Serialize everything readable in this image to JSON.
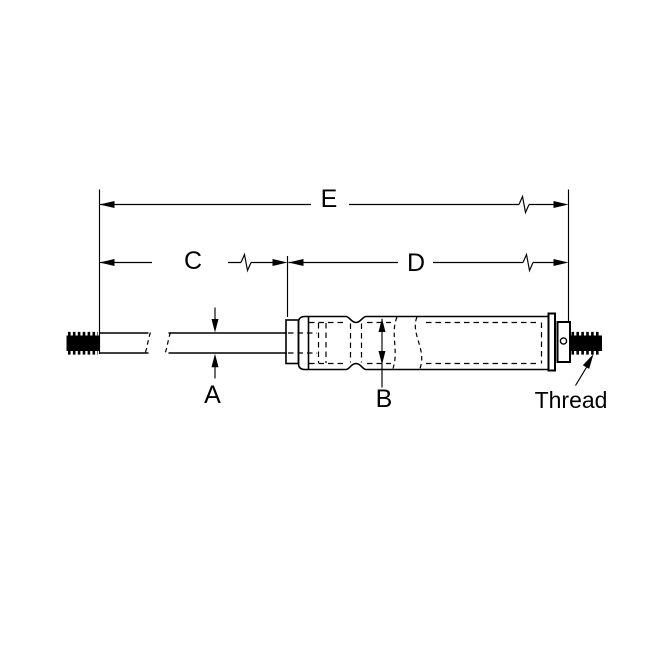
{
  "figure": {
    "type": "technical-dimension-drawing",
    "subject": "gas-spring-side-view",
    "labels": {
      "dim_a": "A",
      "dim_b": "B",
      "dim_c": "C",
      "dim_d": "D",
      "dim_e": "E",
      "thread": "Thread"
    },
    "colors": {
      "line": "#000000",
      "background": "#ffffff",
      "thread_fill": "#000000"
    }
  }
}
